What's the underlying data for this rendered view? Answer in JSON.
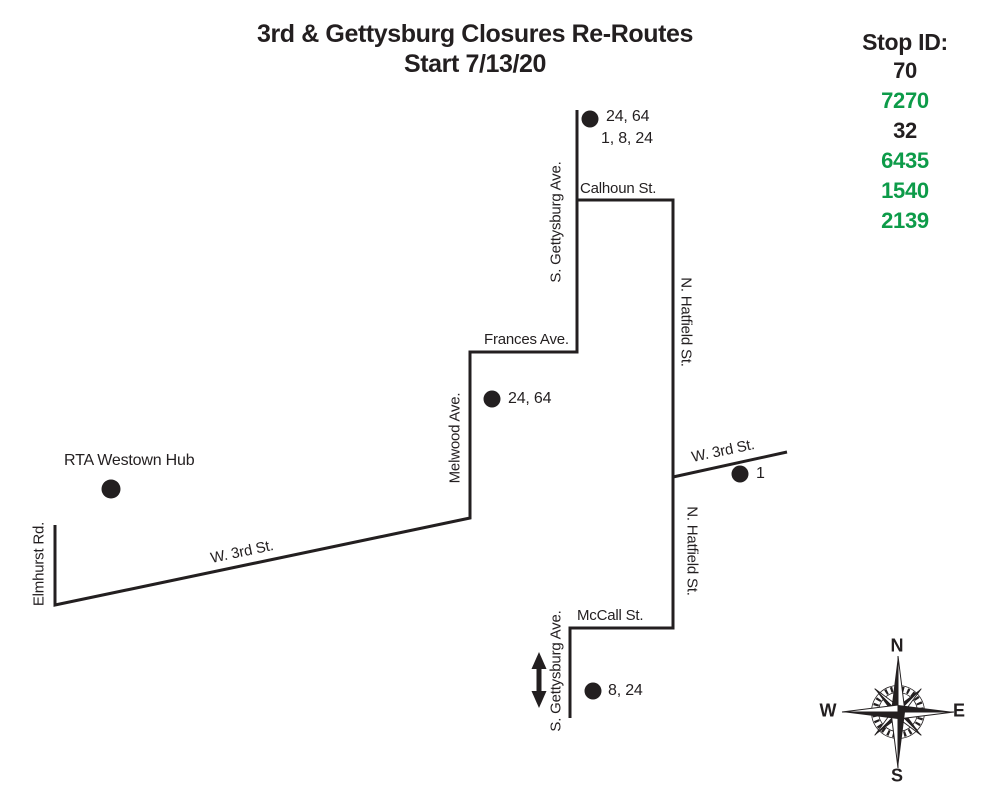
{
  "colors": {
    "ink": "#231f20",
    "stop_green": "#0d9b49",
    "background": "#ffffff"
  },
  "title": {
    "line1": "3rd & Gettysburg Closures Re-Routes",
    "line2": "Start 7/13/20"
  },
  "stop_id_panel": {
    "header": "Stop ID:",
    "items": [
      {
        "value": "70",
        "color": "#231f20"
      },
      {
        "value": "7270",
        "color": "#0d9b49"
      },
      {
        "value": "32",
        "color": "#231f20"
      },
      {
        "value": "6435",
        "color": "#0d9b49"
      },
      {
        "value": "1540",
        "color": "#0d9b49"
      },
      {
        "value": "2139",
        "color": "#0d9b49"
      }
    ]
  },
  "streets": {
    "s_gettysburg_top": "S. Gettysburg Ave.",
    "calhoun": "Calhoun St.",
    "n_hatfield_upper": "N. Hatfield St.",
    "n_hatfield_lower": "N. Hatfield St.",
    "frances": "Frances Ave.",
    "melwood": "Melwood Ave.",
    "w_3rd_west": "W. 3rd St.",
    "w_3rd_east": "W. 3rd St.",
    "elmhurst": "Elmhurst Rd.",
    "mccall": "McCall St.",
    "s_gettysburg_bottom": "S. Gettysburg Ave."
  },
  "stops": {
    "hub_label": "RTA Westown Hub",
    "top_routes_line1": "24, 64",
    "top_routes_line2": "1, 8, 24",
    "frances_routes": "24, 64",
    "east_route": "1",
    "south_routes": "8, 24"
  },
  "compass": {
    "n": "N",
    "e": "E",
    "s": "S",
    "w": "W"
  }
}
